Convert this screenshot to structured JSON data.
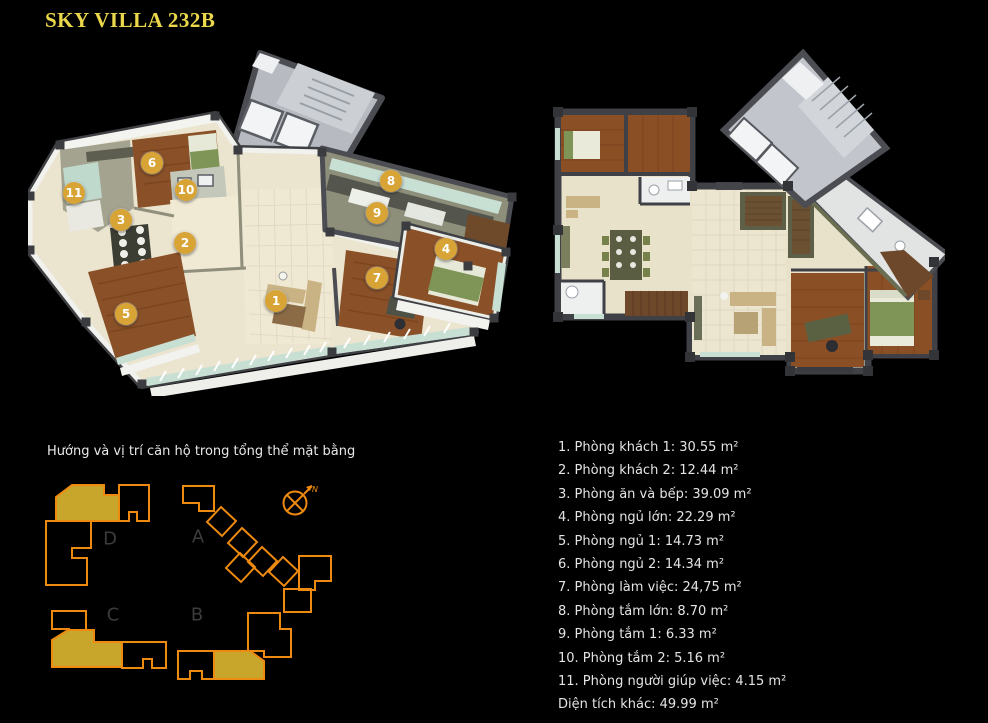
{
  "title": {
    "text": "SKY VILLA 232B",
    "color": "#ead74b"
  },
  "plans": {
    "plan_3d": {
      "description": "3D isometric cutaway floor plan with numbered room markers",
      "marker_style": {
        "background": "#d9a436",
        "text_color": "#ffffff"
      },
      "markers": [
        {
          "n": "1",
          "x": 276,
          "y": 301
        },
        {
          "n": "2",
          "x": 185,
          "y": 243
        },
        {
          "n": "3",
          "x": 121,
          "y": 220
        },
        {
          "n": "4",
          "x": 446,
          "y": 249
        },
        {
          "n": "5",
          "x": 126,
          "y": 314
        },
        {
          "n": "6",
          "x": 152,
          "y": 163
        },
        {
          "n": "7",
          "x": 377,
          "y": 278
        },
        {
          "n": "8",
          "x": 391,
          "y": 181
        },
        {
          "n": "9",
          "x": 377,
          "y": 213
        },
        {
          "n": "10",
          "x": 186,
          "y": 190
        },
        {
          "n": "11",
          "x": 74,
          "y": 193
        }
      ]
    },
    "plan_2d": {
      "description": "Top-down furnished floor plan with rotated elevator core"
    }
  },
  "site_plan": {
    "caption": "Hướng và vị trí căn hộ trong tổng thể mặt bằng",
    "building_labels": [
      {
        "text": "D",
        "x": 110,
        "y": 539
      },
      {
        "text": "A",
        "x": 198,
        "y": 537
      },
      {
        "text": "C",
        "x": 113,
        "y": 615
      },
      {
        "text": "B",
        "x": 197,
        "y": 615
      }
    ],
    "north_label": "N",
    "outline_color": "#ee8a0f",
    "highlight_color": "#c7a62b",
    "label_color": "#3c3c3c"
  },
  "room_list": {
    "items": [
      {
        "num": "1.",
        "name": "Phòng khách 1",
        "area": "30.55 m²"
      },
      {
        "num": "2.",
        "name": "Phòng khách 2",
        "area": "12.44 m²"
      },
      {
        "num": "3.",
        "name": "Phòng ăn và bếp",
        "area": "39.09 m²"
      },
      {
        "num": "4.",
        "name": "Phòng ngủ lớn",
        "area": "22.29 m²"
      },
      {
        "num": "5.",
        "name": "Phòng ngủ 1",
        "area": "14.73 m²"
      },
      {
        "num": "6.",
        "name": "Phòng ngủ 2",
        "area": "14.34 m²"
      },
      {
        "num": "7.",
        "name": "Phòng làm việc",
        "area": "24,75 m²"
      },
      {
        "num": "8.",
        "name": "Phòng tắm lớn",
        "area": "8.70 m²"
      },
      {
        "num": "9.",
        "name": "Phòng tắm 1",
        "area": "6.33 m²"
      },
      {
        "num": "10.",
        "name": "Phòng tắm 2",
        "area": "5.16 m²"
      },
      {
        "num": "11.",
        "name": "Phòng người giúp việc",
        "area": "4.15 m²"
      }
    ],
    "footer": {
      "name": "Diện tích khác",
      "area": "49.99 m²"
    },
    "text_color": "#e4e4e4"
  }
}
